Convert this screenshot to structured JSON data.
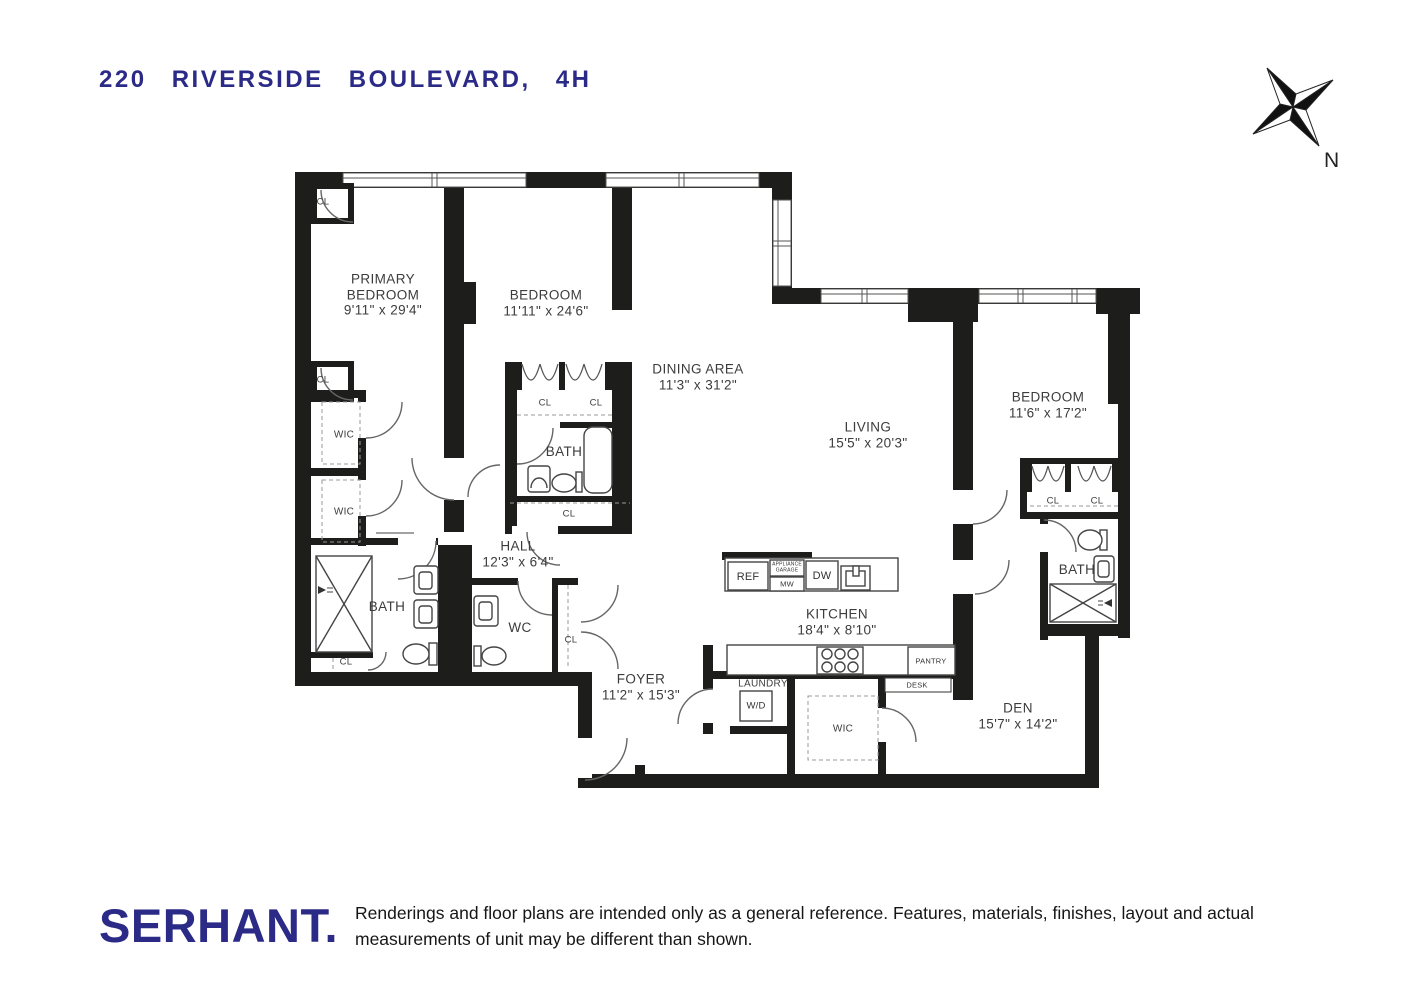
{
  "title": "220 RIVERSIDE BOULEVARD, 4H",
  "compass": {
    "north": "N"
  },
  "rooms": {
    "primary_bedroom": {
      "name": "PRIMARY BEDROOM",
      "dims": "9'11\" x 29'4\""
    },
    "bedroom_2": {
      "name": "BEDROOM",
      "dims": "11'11\" x 24'6\""
    },
    "dining_area": {
      "name": "DINING AREA",
      "dims": "11'3\" x 31'2\""
    },
    "living": {
      "name": "LIVING",
      "dims": "15'5\" x 20'3\""
    },
    "bedroom_3": {
      "name": "BEDROOM",
      "dims": "11'6\" x 17'2\""
    },
    "hall": {
      "name": "HALL",
      "dims": "12'3\" x 6'4\""
    },
    "kitchen": {
      "name": "KITCHEN",
      "dims": "18'4\" x 8'10\""
    },
    "foyer": {
      "name": "FOYER",
      "dims": "11'2\" x 15'3\""
    },
    "den": {
      "name": "DEN",
      "dims": "15'7\" x 14'2\""
    },
    "primary_bath": {
      "name": "BATH"
    },
    "hall_bath": {
      "name": "BATH"
    },
    "bedroom3_bath": {
      "name": "BATH"
    },
    "wc": {
      "name": "WC"
    },
    "laundry": {
      "name": "LAUNDRY"
    }
  },
  "labels": {
    "closet": "CL",
    "walk_in_closet": "WIC",
    "washer_dryer": "W/D",
    "refrigerator": "REF",
    "appliance_garage": "APPLIANCE GARAGE",
    "microwave": "MW",
    "dishwasher": "DW",
    "pantry": "PANTRY",
    "desk": "DESK"
  },
  "footer": {
    "brand": "SERHANT.",
    "disclaimer": "Renderings and floor plans are intended only as a general reference. Features, materials, finishes, layout and actual measurements of unit may be different than shown."
  },
  "colors": {
    "brand_navy": "#2b2b87",
    "wall_black": "#1d1d1b"
  }
}
